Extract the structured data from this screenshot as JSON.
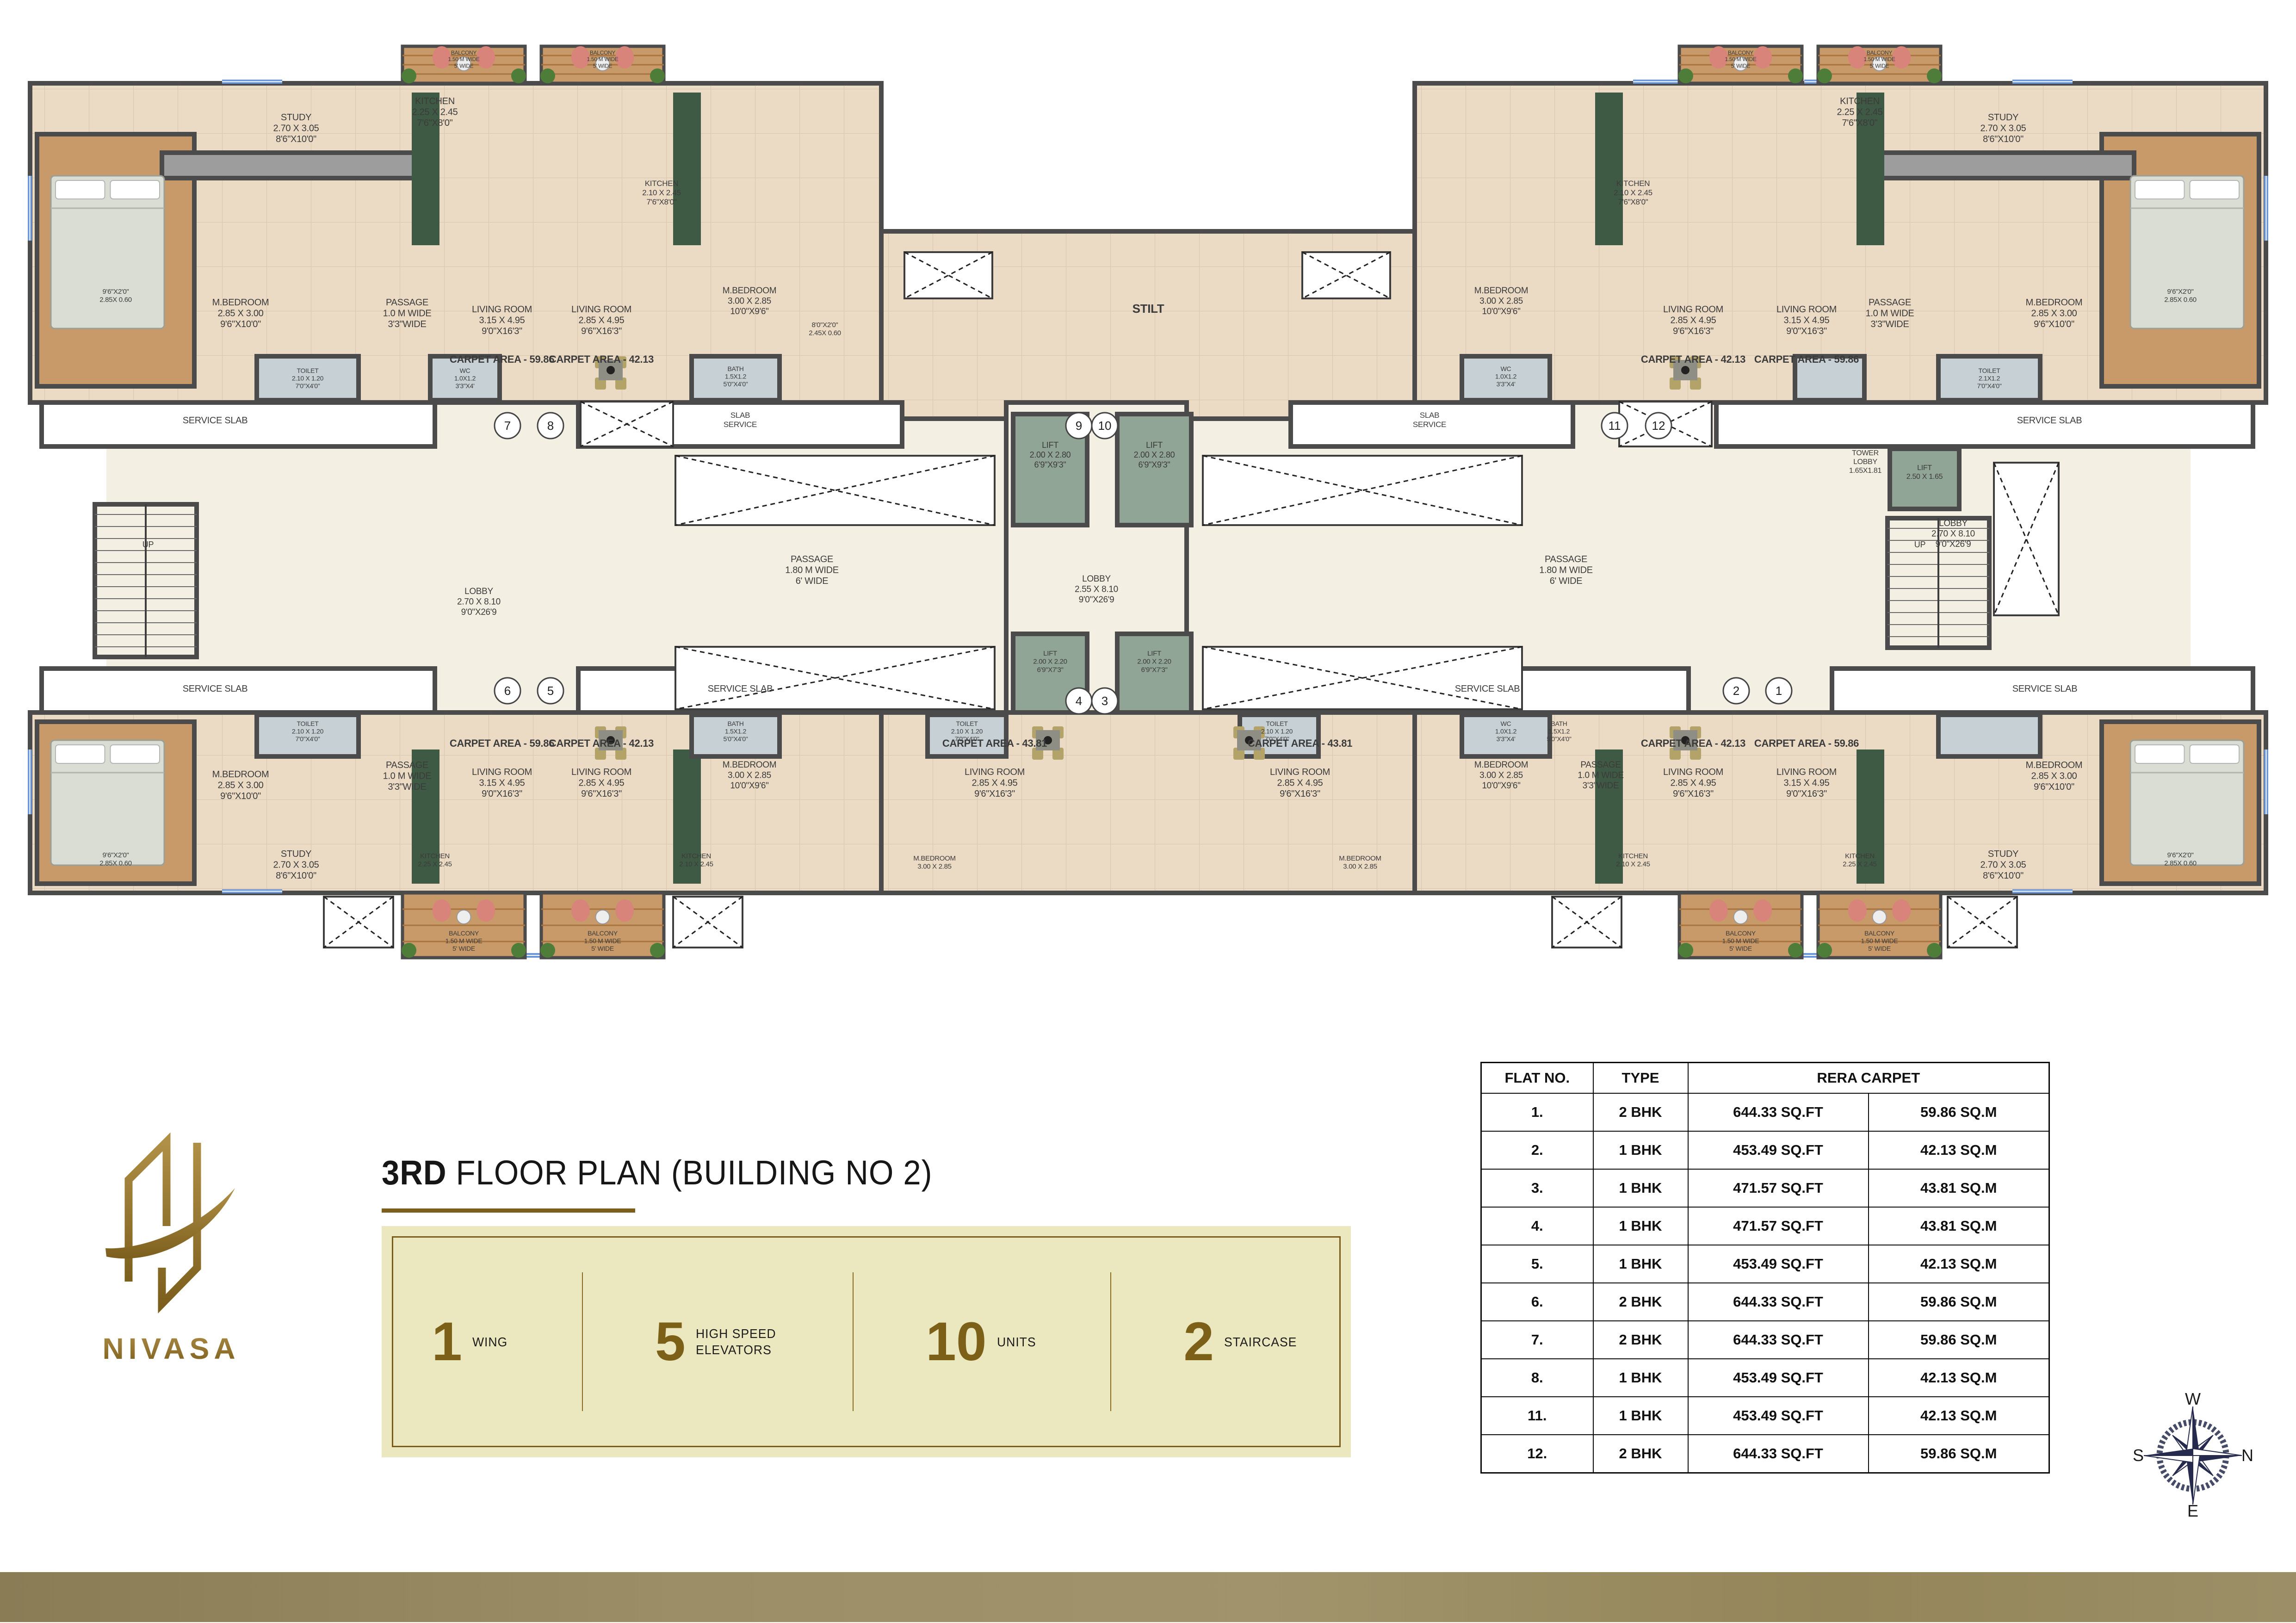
{
  "title": {
    "bold": "3RD",
    "rest": " FLOOR PLAN (BUILDING NO 2)"
  },
  "brand": {
    "name": "NIVASA"
  },
  "stats": {
    "items": [
      {
        "value": "1",
        "label": "WING"
      },
      {
        "value": "5",
        "label": "HIGH SPEED|ELEVATORS"
      },
      {
        "value": "10",
        "label": "UNITS"
      },
      {
        "value": "2",
        "label": "STAIRCASE"
      }
    ]
  },
  "flat_table": {
    "headers": {
      "flat": "FLAT NO.",
      "type": "TYPE",
      "rera": "RERA CARPET"
    },
    "rows": [
      {
        "flat": "1.",
        "type": "2 BHK",
        "sqft": "644.33 SQ.FT",
        "sqm": "59.86 SQ.M"
      },
      {
        "flat": "2.",
        "type": "1 BHK",
        "sqft": "453.49 SQ.FT",
        "sqm": "42.13 SQ.M"
      },
      {
        "flat": "3.",
        "type": "1 BHK",
        "sqft": "471.57 SQ.FT",
        "sqm": "43.81 SQ.M"
      },
      {
        "flat": "4.",
        "type": "1 BHK",
        "sqft": "471.57 SQ.FT",
        "sqm": "43.81 SQ.M"
      },
      {
        "flat": "5.",
        "type": "1 BHK",
        "sqft": "453.49 SQ.FT",
        "sqm": "42.13 SQ.M"
      },
      {
        "flat": "6.",
        "type": "2 BHK",
        "sqft": "644.33 SQ.FT",
        "sqm": "59.86 SQ.M"
      },
      {
        "flat": "7.",
        "type": "2 BHK",
        "sqft": "644.33 SQ.FT",
        "sqm": "59.86 SQ.M"
      },
      {
        "flat": "8.",
        "type": "1 BHK",
        "sqft": "453.49 SQ.FT",
        "sqm": "42.13 SQ.M"
      },
      {
        "flat": "11.",
        "type": "1 BHK",
        "sqft": "453.49 SQ.FT",
        "sqm": "42.13 SQ.M"
      },
      {
        "flat": "12.",
        "type": "2 BHK",
        "sqft": "644.33 SQ.FT",
        "sqm": "59.86 SQ.M"
      }
    ]
  },
  "compass": {
    "top": "W",
    "right": "N",
    "bottom": "E",
    "left": "S"
  },
  "plan": {
    "colors": {
      "wall": "#4b4b4b",
      "beige": "#ebdac4",
      "cream": "#f3efe2",
      "sage": "#91a596",
      "wood": "#c89a69",
      "bath": "#c7d1d5",
      "gray": "#9d9d9d",
      "white": "#ffffff",
      "granite": "#3f5a44",
      "txt": "#3b3b3b",
      "blue": "#6b97d8",
      "red": "#d8847a",
      "green": "#4e7d3a",
      "chair": "#b3a368"
    },
    "rects": [
      [
        230,
        870,
        4505,
        670,
        "cream",
        0
      ],
      [
        65,
        180,
        1840,
        690,
        "beige",
        1
      ],
      [
        3058,
        180,
        1840,
        690,
        "beige",
        1
      ],
      [
        1905,
        500,
        1153,
        405,
        "beige",
        1
      ],
      [
        65,
        1540,
        1840,
        390,
        "beige",
        1
      ],
      [
        1905,
        1540,
        1153,
        390,
        "beige",
        1
      ],
      [
        3058,
        1540,
        1840,
        390,
        "beige",
        1
      ],
      [
        2175,
        870,
        390,
        670,
        "cream",
        1
      ],
      [
        90,
        870,
        850,
        95,
        "white",
        1
      ],
      [
        1250,
        870,
        700,
        95,
        "white",
        1
      ],
      [
        2790,
        870,
        610,
        95,
        "white",
        1
      ],
      [
        3710,
        870,
        1160,
        95,
        "white",
        1
      ],
      [
        90,
        1445,
        850,
        95,
        "white",
        1
      ],
      [
        1250,
        1445,
        700,
        95,
        "white",
        1
      ],
      [
        2790,
        1445,
        860,
        95,
        "white",
        1
      ],
      [
        3960,
        1445,
        910,
        95,
        "white",
        1
      ],
      [
        80,
        290,
        340,
        545,
        "wood",
        1
      ],
      [
        4543,
        290,
        340,
        545,
        "wood",
        1
      ],
      [
        80,
        1560,
        340,
        350,
        "wood",
        1
      ],
      [
        4543,
        1560,
        340,
        350,
        "wood",
        1
      ],
      [
        350,
        330,
        590,
        55,
        "gray",
        1
      ],
      [
        4023,
        330,
        590,
        55,
        "gray",
        1
      ],
      [
        890,
        200,
        60,
        330,
        "granite",
        0
      ],
      [
        1455,
        200,
        60,
        330,
        "granite",
        0
      ],
      [
        3448,
        200,
        60,
        330,
        "granite",
        0
      ],
      [
        4013,
        200,
        60,
        330,
        "granite",
        0
      ],
      [
        890,
        1620,
        60,
        290,
        "granite",
        0
      ],
      [
        1455,
        1620,
        60,
        290,
        "granite",
        0
      ],
      [
        3448,
        1620,
        60,
        290,
        "granite",
        0
      ],
      [
        4013,
        1620,
        60,
        290,
        "granite",
        0
      ],
      [
        555,
        770,
        220,
        95,
        "bath",
        1
      ],
      [
        930,
        770,
        150,
        95,
        "bath",
        1
      ],
      [
        1495,
        770,
        190,
        95,
        "bath",
        1
      ],
      [
        3160,
        770,
        190,
        95,
        "bath",
        1
      ],
      [
        3880,
        770,
        150,
        95,
        "bath",
        1
      ],
      [
        4190,
        770,
        220,
        95,
        "bath",
        1
      ],
      [
        555,
        1545,
        220,
        90,
        "bath",
        1
      ],
      [
        1495,
        1545,
        190,
        90,
        "bath",
        1
      ],
      [
        2005,
        1545,
        170,
        90,
        "bath",
        1
      ],
      [
        2680,
        1545,
        170,
        90,
        "bath",
        1
      ],
      [
        3160,
        1545,
        190,
        90,
        "bath",
        1
      ],
      [
        4190,
        1545,
        220,
        90,
        "bath",
        1
      ],
      [
        2190,
        895,
        160,
        240,
        "sage",
        1
      ],
      [
        2415,
        895,
        160,
        240,
        "sage",
        1
      ],
      [
        2190,
        1370,
        160,
        170,
        "sage",
        1
      ],
      [
        2415,
        1370,
        160,
        170,
        "sage",
        1
      ],
      [
        4085,
        970,
        150,
        130,
        "sage",
        1
      ]
    ],
    "labels": [
      [
        640,
        240,
        "STUDY|2.70 X 3.05|8'6\"X10'0\"",
        20
      ],
      [
        940,
        205,
        "KITCHEN|2.25 X 2.45|7'6\"X8'0\"",
        20
      ],
      [
        250,
        620,
        "9'6\"X2'0\"|2.85X 0.60",
        15
      ],
      [
        520,
        640,
        "M.BEDROOM|2.85 X 3.00|9'6\"X10'0\"",
        20
      ],
      [
        880,
        640,
        "PASSAGE|1.0 M WIDE|3'3\"WIDE",
        20
      ],
      [
        1085,
        655,
        "LIVING ROOM|3.15 X 4.95|9'0\"X16'3\"",
        20
      ],
      [
        1085,
        762,
        "CARPET AREA - 59.86",
        22
      ],
      [
        665,
        792,
        "TOILET|2.10 X 1.20|7'0\"X4'0\"",
        14
      ],
      [
        1005,
        792,
        "WC|1.0X1.2|3'3\"X4'",
        14
      ],
      [
        1300,
        655,
        "LIVING ROOM|2.85 X 4.95|9'6\"X16'3\"",
        20
      ],
      [
        1300,
        762,
        "CARPET AREA - 42.13",
        22
      ],
      [
        1430,
        385,
        "KITCHEN|2.10 X 2.45|7'6\"X8'0\"",
        17
      ],
      [
        1620,
        615,
        "M.BEDROOM|3.00 X 2.85|10'0\"X9'6\"",
        19
      ],
      [
        1783,
        692,
        "8'0\"X2'0\"|2.45X 0.60",
        15
      ],
      [
        1590,
        788,
        "BATH|1.5X1.2|5'0\"X4'0\"",
        14
      ],
      [
        3245,
        615,
        "M.BEDROOM|3.00 X 2.85|10'0\"X9'6\"",
        19
      ],
      [
        3255,
        788,
        "WC|1.0X1.2|3'3\"X4'",
        14
      ],
      [
        3530,
        385,
        "KITCHEN|2.10 X 2.45|7'6\"X8'0\"",
        17
      ],
      [
        3660,
        655,
        "LIVING ROOM|2.85 X 4.95|9'6\"X16'3\"",
        20
      ],
      [
        3660,
        762,
        "CARPET AREA - 42.13",
        22
      ],
      [
        3905,
        655,
        "LIVING ROOM|3.15 X 4.95|9'0\"X16'3\"",
        20
      ],
      [
        3905,
        762,
        "CARPET AREA - 59.86",
        22
      ],
      [
        4020,
        205,
        "KITCHEN|2.25 X 2.45|7'6\"X8'0\"",
        20
      ],
      [
        4330,
        240,
        "STUDY|2.70 X 3.05|8'6\"X10'0\"",
        20
      ],
      [
        4085,
        640,
        "PASSAGE|1.0 M WIDE|3'3\"WIDE",
        20
      ],
      [
        4440,
        640,
        "M.BEDROOM|2.85 X 3.00|9'6\"X10'0\"",
        20
      ],
      [
        4713,
        620,
        "9'6\"X2'0\"|2.85X 0.60",
        15
      ],
      [
        4300,
        792,
        "TOILET|2.1X1.2|7'0\"X4'0\"",
        14
      ],
      [
        2482,
        650,
        "STILT",
        26
      ],
      [
        465,
        895,
        "SERVICE SLAB",
        20
      ],
      [
        1600,
        886,
        "SLAB|SERVICE",
        17
      ],
      [
        3090,
        886,
        "SLAB|SERVICE",
        17
      ],
      [
        4430,
        895,
        "SERVICE SLAB",
        20
      ],
      [
        465,
        1475,
        "SERVICE SLAB",
        20
      ],
      [
        1600,
        1475,
        "SERVICE SLAB",
        20
      ],
      [
        3215,
        1475,
        "SERVICE SLAB",
        20
      ],
      [
        4420,
        1475,
        "SERVICE SLAB",
        20
      ],
      [
        2270,
        950,
        "LIFT|2.00 X 2.80|6'9\"X9'3\"",
        18
      ],
      [
        2495,
        950,
        "LIFT|2.00 X 2.80|6'9\"X9'3\"",
        18
      ],
      [
        2270,
        1402,
        "LIFT|2.00 X 2.20|6'9\"X7'3\"",
        15
      ],
      [
        2495,
        1402,
        "LIFT|2.00 X 2.20|6'9\"X7'3\"",
        15
      ],
      [
        4160,
        1000,
        "LIFT|2.50 X 1.65",
        16
      ],
      [
        2370,
        1238,
        "LOBBY|2.55 X 8.10|9'0\"X26'9",
        19
      ],
      [
        1035,
        1265,
        "LOBBY|2.70 X 8.10|9'0\"X26'9",
        19
      ],
      [
        4222,
        1118,
        "LOBBY|2.70 X 8.10|9'0\"X26'9",
        19
      ],
      [
        1755,
        1195,
        "PASSAGE|1.80 M WIDE|6' WIDE",
        20
      ],
      [
        3385,
        1195,
        "PASSAGE|1.80 M WIDE|6' WIDE",
        20
      ],
      [
        4032,
        968,
        "TOWER|LOBBY|1.65X1.81",
        16
      ],
      [
        320,
        1165,
        "UP",
        18
      ],
      [
        4150,
        1165,
        "UP",
        18
      ],
      [
        520,
        1660,
        "M.BEDROOM|2.85 X 3.00|9'6\"X10'0\"",
        20
      ],
      [
        250,
        1838,
        "9'6\"X2'0\"|2.85X 0.60",
        15
      ],
      [
        640,
        1832,
        "STUDY|2.70 X 3.05|8'6\"X10'0\"",
        20
      ],
      [
        880,
        1640,
        "PASSAGE|1.0 M WIDE|3'3\"WIDE",
        20
      ],
      [
        1085,
        1592,
        "CARPET AREA - 59.86",
        22
      ],
      [
        1085,
        1655,
        "LIVING ROOM|3.15 X 4.95|9'0\"X16'3\"",
        20
      ],
      [
        940,
        1840,
        "KITCHEN|2.25 X 2.45",
        15
      ],
      [
        665,
        1555,
        "TOILET|2.10 X 1.20|7'0\"X4'0\"",
        14
      ],
      [
        1300,
        1592,
        "CARPET AREA - 42.13",
        22
      ],
      [
        1300,
        1655,
        "LIVING ROOM|2.85 X 4.95|9'6\"X16'3\"",
        20
      ],
      [
        1505,
        1840,
        "KITCHEN|2.10 X 2.45",
        15
      ],
      [
        1620,
        1640,
        "M.BEDROOM|3.00 X 2.85|10'0\"X9'6\"",
        19
      ],
      [
        1590,
        1555,
        "BATH|1.5X1.2|5'0\"X4'0\"",
        14
      ],
      [
        2090,
        1555,
        "TOILET|2.10 X 1.20|7'0\"X4'0\"",
        14
      ],
      [
        2150,
        1592,
        "CARPET AREA - 43.81",
        22
      ],
      [
        2150,
        1655,
        "LIVING ROOM|2.85 X 4.95|9'6\"X16'3\"",
        20
      ],
      [
        2020,
        1845,
        "M.BEDROOM|3.00 X 2.85",
        15
      ],
      [
        2760,
        1555,
        "TOILET|2.10 X 1.20|7'0\"X4'0\"",
        14
      ],
      [
        2810,
        1592,
        "CARPET AREA - 43.81",
        22
      ],
      [
        2810,
        1655,
        "LIVING ROOM|2.85 X 4.95|9'6\"X16'3\"",
        20
      ],
      [
        2940,
        1845,
        "M.BEDROOM|3.00 X 2.85",
        15
      ],
      [
        3245,
        1640,
        "M.BEDROOM|3.00 X 2.85|10'0\"X9'6\"",
        19
      ],
      [
        3255,
        1555,
        "WC|1.0X1.2|3'3\"X4'",
        14
      ],
      [
        3370,
        1555,
        "BATH|1.5X1.2|5'0\"X4'0\"",
        14
      ],
      [
        3460,
        1640,
        "PASSAGE|1.0 M WIDE|3'3\"WIDE",
        19
      ],
      [
        3660,
        1592,
        "CARPET AREA - 42.13",
        22
      ],
      [
        3660,
        1655,
        "LIVING ROOM|2.85 X 4.95|9'6\"X16'3\"",
        20
      ],
      [
        3530,
        1840,
        "KITCHEN|2.10 X 2.45",
        15
      ],
      [
        3905,
        1592,
        "CARPET AREA - 59.86",
        22
      ],
      [
        3905,
        1655,
        "LIVING ROOM|3.15 X 4.95|9'0\"X16'3\"",
        20
      ],
      [
        4020,
        1840,
        "KITCHEN|2.25 X 2.45",
        15
      ],
      [
        4330,
        1832,
        "STUDY|2.70 X 3.05|8'6\"X10'0\"",
        20
      ],
      [
        4440,
        1640,
        "M.BEDROOM|2.85 X 3.00|9'6\"X10'0\"",
        20
      ],
      [
        4713,
        1838,
        "9'6\"X2'0\"|2.85X 0.60",
        15
      ]
    ],
    "circles": [
      [
        1097,
        920,
        "7"
      ],
      [
        1190,
        920,
        "8"
      ],
      [
        2332,
        920,
        "9"
      ],
      [
        2388,
        920,
        "10"
      ],
      [
        3490,
        920,
        "11"
      ],
      [
        3585,
        920,
        "12"
      ],
      [
        1097,
        1493,
        "6"
      ],
      [
        1190,
        1493,
        "5"
      ],
      [
        2332,
        1515,
        "4"
      ],
      [
        2388,
        1515,
        "3"
      ],
      [
        3753,
        1493,
        "2"
      ],
      [
        3845,
        1493,
        "1"
      ]
    ],
    "crosses": [
      [
        1255,
        868,
        200,
        97
      ],
      [
        3500,
        868,
        200,
        97
      ],
      [
        1460,
        985,
        690,
        150
      ],
      [
        2600,
        985,
        690,
        150
      ],
      [
        1460,
        1398,
        690,
        135
      ],
      [
        2600,
        1398,
        690,
        135
      ],
      [
        1955,
        545,
        190,
        100
      ],
      [
        2815,
        545,
        190,
        100
      ],
      [
        4310,
        1000,
        140,
        330
      ],
      [
        700,
        1938,
        150,
        110
      ],
      [
        1455,
        1938,
        150,
        110
      ],
      [
        3355,
        1938,
        150,
        110
      ],
      [
        4210,
        1938,
        150,
        110
      ]
    ],
    "balconies": {
      "label": "BALCONY|1.50 M WIDE|5' WIDE",
      "top": [
        [
          870,
          100,
          265,
          80
        ],
        [
          1170,
          100,
          265,
          80
        ],
        [
          3630,
          100,
          265,
          80
        ],
        [
          3930,
          100,
          265,
          80
        ]
      ],
      "bottom": [
        [
          870,
          1930,
          265,
          140
        ],
        [
          1170,
          1930,
          265,
          140
        ],
        [
          3630,
          1930,
          265,
          140
        ],
        [
          3930,
          1930,
          265,
          140
        ]
      ]
    },
    "stairs": [
      [
        205,
        1090,
        220,
        330
      ],
      [
        4080,
        1120,
        220,
        280
      ]
    ],
    "windows": [
      [
        480,
        172,
        130,
        9
      ],
      [
        950,
        172,
        110,
        9
      ],
      [
        1320,
        172,
        110,
        9
      ],
      [
        3530,
        172,
        110,
        9
      ],
      [
        3900,
        172,
        110,
        9
      ],
      [
        4350,
        172,
        130,
        9
      ],
      [
        480,
        1922,
        130,
        9
      ],
      [
        4350,
        1922,
        130,
        9
      ],
      [
        875,
        2060,
        555,
        10
      ],
      [
        3635,
        2060,
        555,
        10
      ],
      [
        60,
        380,
        9,
        140
      ],
      [
        60,
        1620,
        9,
        140
      ],
      [
        4894,
        380,
        9,
        140
      ],
      [
        4894,
        1620,
        9,
        140
      ]
    ],
    "beds": [
      [
        110,
        380,
        245,
        330
      ],
      [
        4605,
        380,
        245,
        330
      ],
      [
        110,
        1600,
        245,
        270
      ],
      [
        4605,
        1600,
        245,
        270
      ]
    ],
    "dinings": [
      [
        1320,
        800
      ],
      [
        3643,
        800
      ],
      [
        1320,
        1600
      ],
      [
        2265,
        1600
      ],
      [
        2700,
        1600
      ],
      [
        3643,
        1600
      ]
    ]
  }
}
